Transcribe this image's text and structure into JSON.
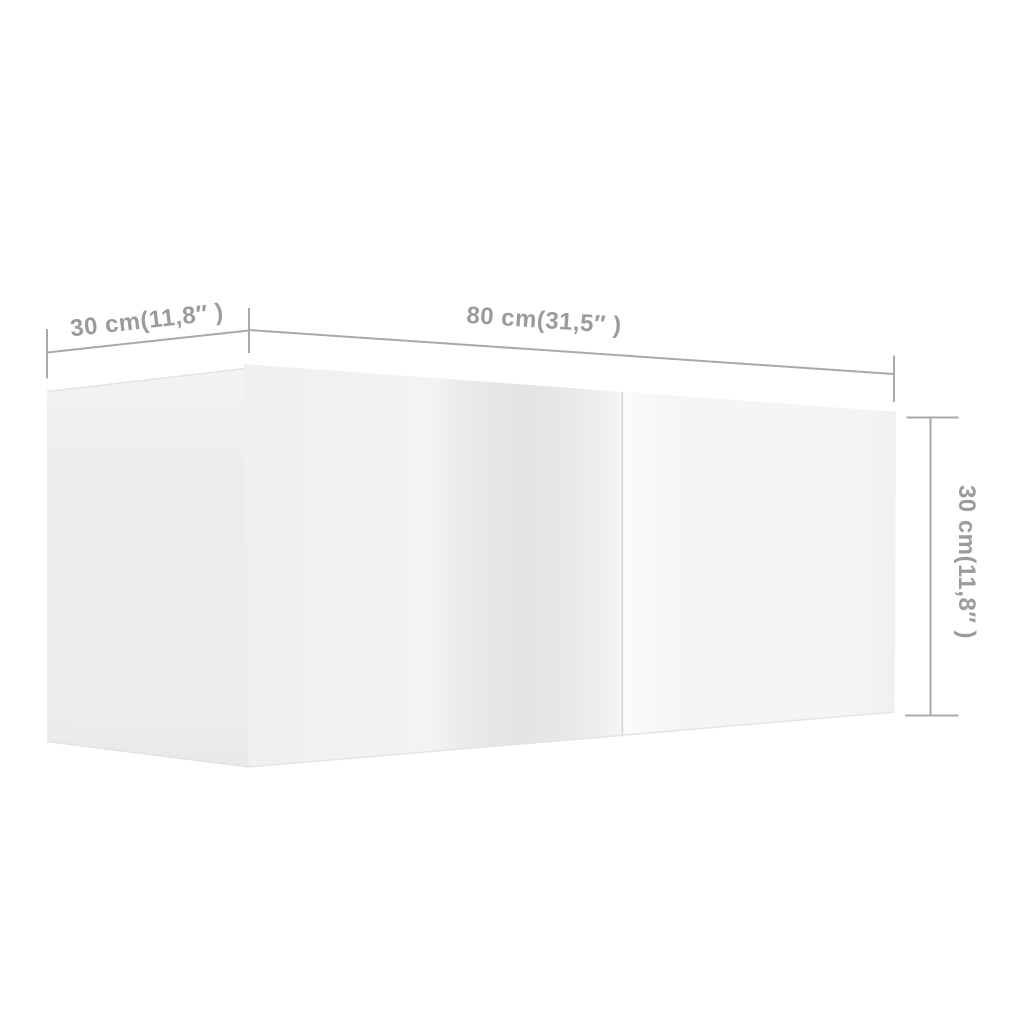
{
  "diagram": {
    "depth_label": "30 cm(11,8″ )",
    "width_label": "80 cm(31,5″ )",
    "height_label": "30 cm(11,8″ )"
  },
  "colors": {
    "background": "#ffffff",
    "side_panel": "#ededed",
    "front_left_door": "#f3f3f3",
    "front_right_door": "#f5f5f5",
    "door_seam": "#d9d9d9",
    "panel_edge": "#e3e3e3",
    "dimension_line": "#a9a9a9",
    "dimension_text": "#9b9b9b"
  }
}
